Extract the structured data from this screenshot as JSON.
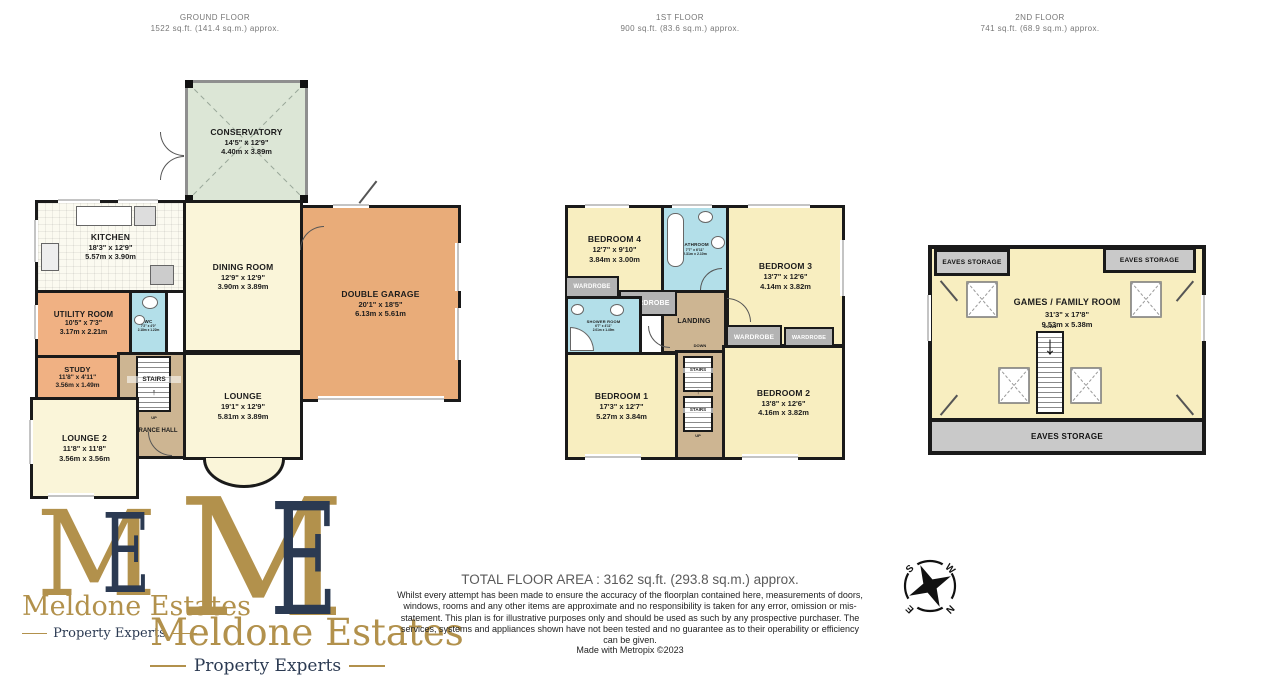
{
  "header": {
    "ground": {
      "title": "GROUND FLOOR",
      "area": "1522 sq.ft. (141.4 sq.m.) approx."
    },
    "first": {
      "title": "1ST FLOOR",
      "area": "900 sq.ft. (83.6 sq.m.) approx."
    },
    "second": {
      "title": "2ND FLOOR",
      "area": "741 sq.ft. (68.9 sq.m.) approx."
    }
  },
  "ground": {
    "conservatory": {
      "name": "CONSERVATORY",
      "imp": "14'5\" x 12'9\"",
      "met": "4.40m x 3.89m"
    },
    "kitchen": {
      "name": "KITCHEN",
      "imp": "18'3\" x 12'9\"",
      "met": "5.57m x 3.90m"
    },
    "dining": {
      "name": "DINING ROOM",
      "imp": "12'9\" x 12'9\"",
      "met": "3.90m x 3.89m"
    },
    "garage": {
      "name": "DOUBLE GARAGE",
      "imp": "20'1\" x 18'5\"",
      "met": "6.13m x 5.61m"
    },
    "utility": {
      "name": "UTILITY ROOM",
      "imp": "10'5\" x 7'3\"",
      "met": "3.17m x 2.21m"
    },
    "study": {
      "name": "STUDY",
      "imp": "11'8\" x 4'11\"",
      "met": "3.56m x 1.49m"
    },
    "lounge": {
      "name": "LOUNGE",
      "imp": "19'1\" x 12'9\"",
      "met": "5.81m x 3.89m"
    },
    "lounge2": {
      "name": "LOUNGE 2",
      "imp": "11'8\" x 11'8\"",
      "met": "3.56m x 3.56m"
    },
    "wc": {
      "name": "WC",
      "imp": "7'2\" x 4'0\"",
      "met": "2.18m x 1.22m"
    },
    "hall": "ENTRANCE HALL",
    "stairs": "STAIRS",
    "up": "UP"
  },
  "first": {
    "bedroom1": {
      "name": "BEDROOM 1",
      "imp": "17'3\" x 12'7\"",
      "met": "5.27m x 3.84m"
    },
    "bedroom2": {
      "name": "BEDROOM 2",
      "imp": "13'8\" x 12'6\"",
      "met": "4.16m x 3.82m"
    },
    "bedroom3": {
      "name": "BEDROOM 3",
      "imp": "13'7\" x 12'6\"",
      "met": "4.14m x 3.82m"
    },
    "bedroom4": {
      "name": "BEDROOM 4",
      "imp": "12'7\" x 9'10\"",
      "met": "3.84m x 3.00m"
    },
    "bathroom": {
      "name": "BATHROOM",
      "imp": "7'7\" x 6'11\"",
      "met": "2.31m x 2.10m"
    },
    "shower": {
      "name": "SHOWER ROOM",
      "imp": "6'7\" x 4'11\"",
      "met": "2.01m x 1.49m"
    },
    "landing": "LANDING",
    "wardrobe": "WARDROBE",
    "stairs": "STAIRS",
    "up": "UP",
    "down": "DOWN"
  },
  "second": {
    "games": {
      "name": "GAMES / FAMILY ROOM",
      "imp": "31'3\" x 17'8\"",
      "met": "9.53m x 5.38m"
    },
    "eaves": "EAVES STORAGE",
    "down": "DOWN"
  },
  "arrows": {
    "up": "↑",
    "down": "↓"
  },
  "compass": {
    "n": "N",
    "s": "S",
    "e": "E",
    "w": "W"
  },
  "logo": {
    "m": "M",
    "e": "E",
    "name": "Meldone Estates",
    "tagline": "Property Experts"
  },
  "footer": {
    "total": "TOTAL FLOOR AREA : 3162 sq.ft. (293.8 sq.m.) approx.",
    "disclaimer": "Whilst every attempt has been made to ensure the accuracy of the floorplan contained here, measurements of doors, windows, rooms and any other items are approximate and no responsibility is taken for any error, omission or mis-statement. This plan is for illustrative purposes only and should be used as such by any prospective purchaser. The services, systems and appliances shown have not been tested and no guarantee as to their operability or efficiency can be given.",
    "credit": "Made with Metropix ©2023"
  },
  "colors": {
    "gold": "#B2914C",
    "navy": "#2B3A52",
    "cream": "#FAF5D9",
    "pale_yellow": "#F8EEC0",
    "garage_orange": "#E9AC79",
    "utility_orange": "#F0B183",
    "wet_room_cyan": "#B3DFE9",
    "hall_tan": "#CDB592",
    "conservatory_green": "#DCE6D6",
    "storage_gray": "#C9C9C9",
    "wall_black": "#1a1a1a"
  }
}
